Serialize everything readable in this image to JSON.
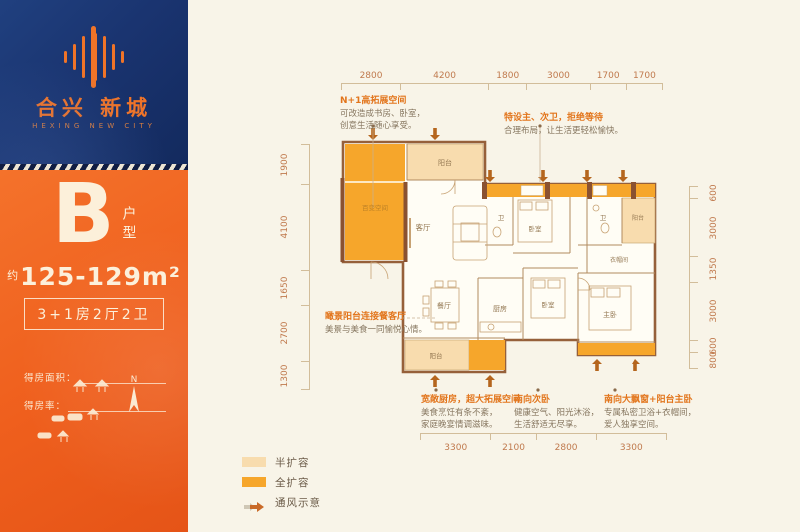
{
  "brand": {
    "name_cn": "合兴 新城",
    "name_en": "HEXING NEW CITY"
  },
  "unit": {
    "letter": "B",
    "type_label": "户型",
    "area_prefix": "约",
    "area_value": "125-129m²",
    "spec": "3+1房2厅2卫",
    "field_area": "得房面积：",
    "field_rate": "得房率：",
    "compass": "N"
  },
  "plan": {
    "rooms": {
      "flex_space": "百变空间",
      "balcony_top": "阳台",
      "living": "客厅",
      "dining": "餐厅",
      "kitchen": "厨房",
      "bath_a": "卫",
      "bath_b": "卫",
      "bedroom_a": "卧室",
      "bedroom_b": "卧室",
      "master": "主卧",
      "cloakroom": "衣帽间",
      "balcony_right": "阳台",
      "balcony_bottom": "阳台"
    },
    "dims_top": [
      "2800",
      "4200",
      "1800",
      "3000",
      "1700",
      "1700"
    ],
    "dims_left": [
      "1900",
      "4100",
      "1650",
      "2700",
      "1300"
    ],
    "dims_right": [
      "600",
      "3000",
      "1350",
      "3000",
      "600",
      "800"
    ],
    "dims_bottom": [
      "3300",
      "2100",
      "2800",
      "3300"
    ],
    "annotations": [
      {
        "title": "N+1高拓展空间",
        "lines": [
          "可改造成书房、卧室，",
          "创意生活随心享受。"
        ]
      },
      {
        "title": "特设主、次卫，拒绝等待",
        "lines": [
          "合理布局，让生活更轻松愉快。"
        ]
      },
      {
        "title": "瞰景阳台连接餐客厅",
        "lines": [
          "美景与美食一同愉悦心情。"
        ]
      },
      {
        "title": "宽敞厨房，超大拓展空间",
        "lines": [
          "美食烹饪有条不紊，",
          "家庭晚宴情调滋味。"
        ]
      },
      {
        "title": "南向次卧",
        "lines": [
          "健康空气、阳光沐浴，",
          "生活舒适无尽享。"
        ]
      },
      {
        "title": "南向大飘窗+阳台主卧",
        "lines": [
          "专属私密卫浴+衣帽间，",
          "爱人独享空间。"
        ]
      }
    ],
    "legend": [
      {
        "label": "半扩容"
      },
      {
        "label": "全扩容"
      },
      {
        "label": "通风示意"
      }
    ]
  },
  "colors": {
    "navy": "#1c3a78",
    "brand_orange": "#f2641e",
    "full_expand": "#f6a62b",
    "half_expand": "#f8dcae",
    "wall": "#96603a",
    "dimension_text": "#c07a4e",
    "annotation_title": "#e2751c"
  }
}
